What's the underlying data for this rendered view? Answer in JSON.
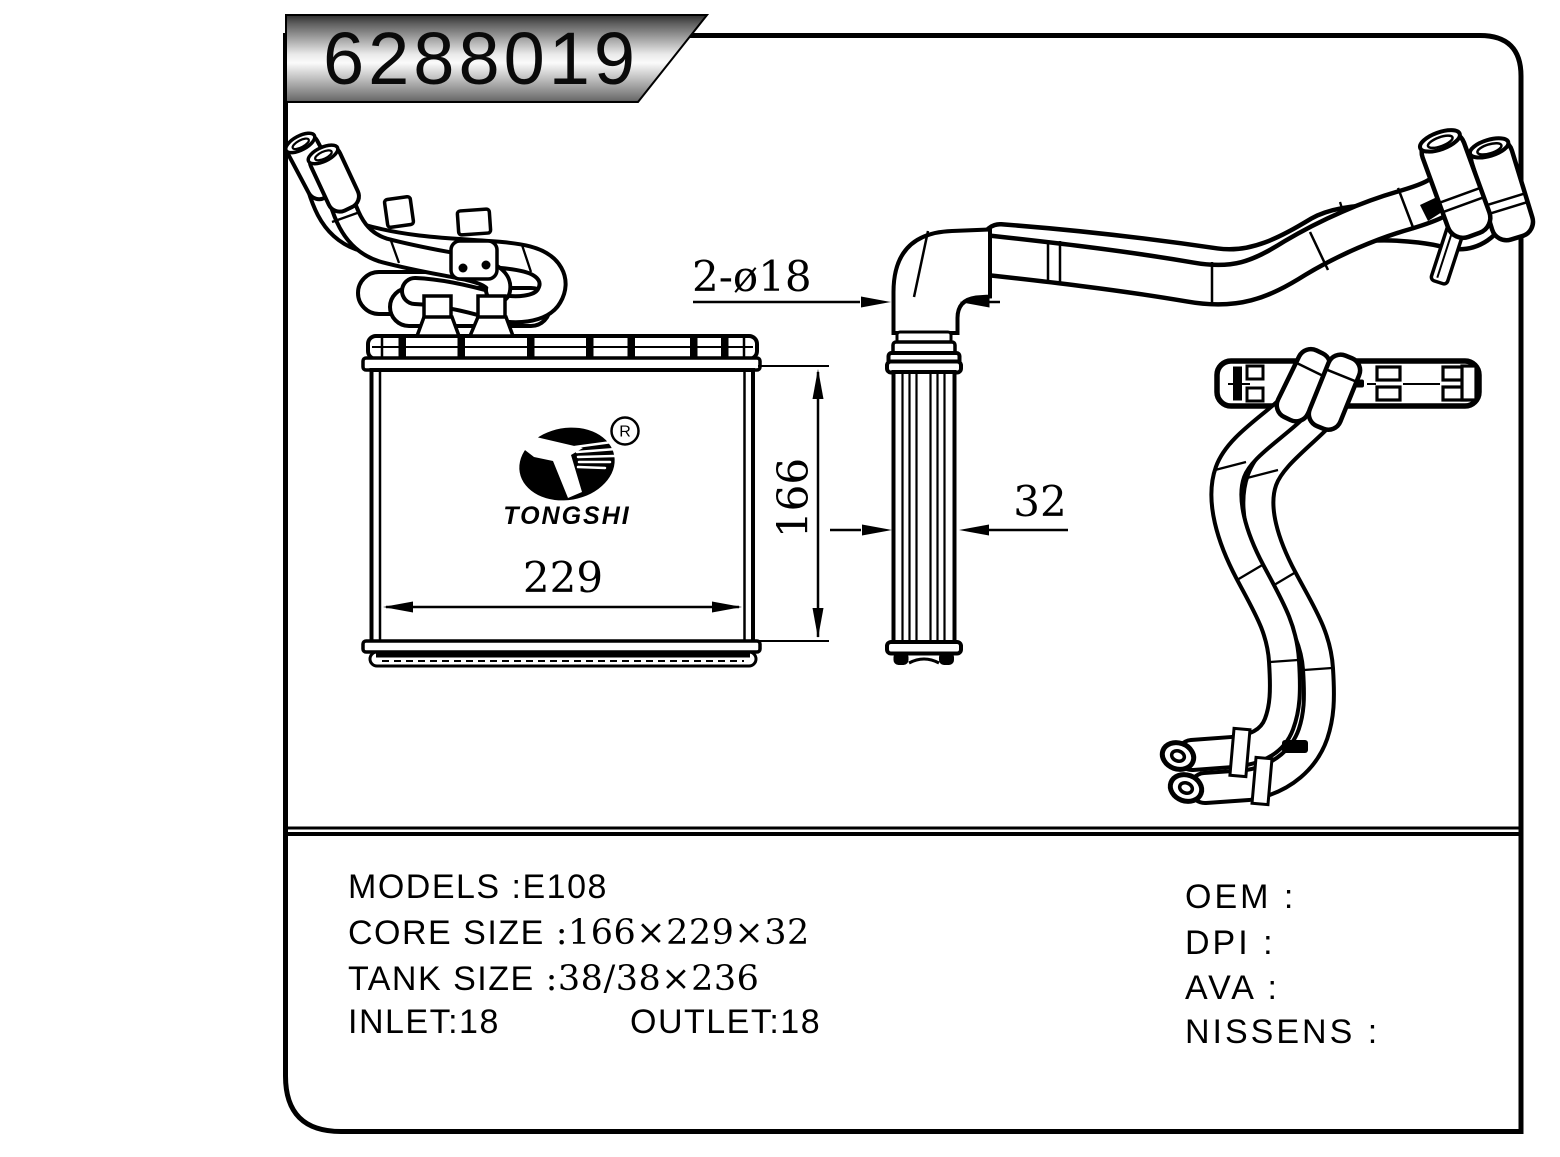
{
  "banner": {
    "part_number": "6288019"
  },
  "logo": {
    "brand": "TONGSHI",
    "registered_mark": "R"
  },
  "dimensions": {
    "port_diameter": "2-ø18",
    "core_height": "166",
    "core_width": "229",
    "core_depth": "32"
  },
  "specs": {
    "models_label": "MODELS",
    "models_value": ":E108",
    "core_size_label": "CORE SIZE",
    "core_size_value": ":166×229×32",
    "tank_size_label": "TANK SIZE",
    "tank_size_value": ":38/38×236",
    "inlet": "INLET:18",
    "outlet": "OUTLET:18",
    "oem": "OEM :",
    "dpi": "DPI :",
    "ava": "AVA :",
    "nissens": "NISSENS :"
  },
  "colors": {
    "line": "#000000",
    "background": "#ffffff",
    "banner_gradient_top": "#2e2e2e",
    "banner_gradient_mid": "#f8f8f8",
    "banner_gradient_bottom": "#6f6f6f"
  }
}
